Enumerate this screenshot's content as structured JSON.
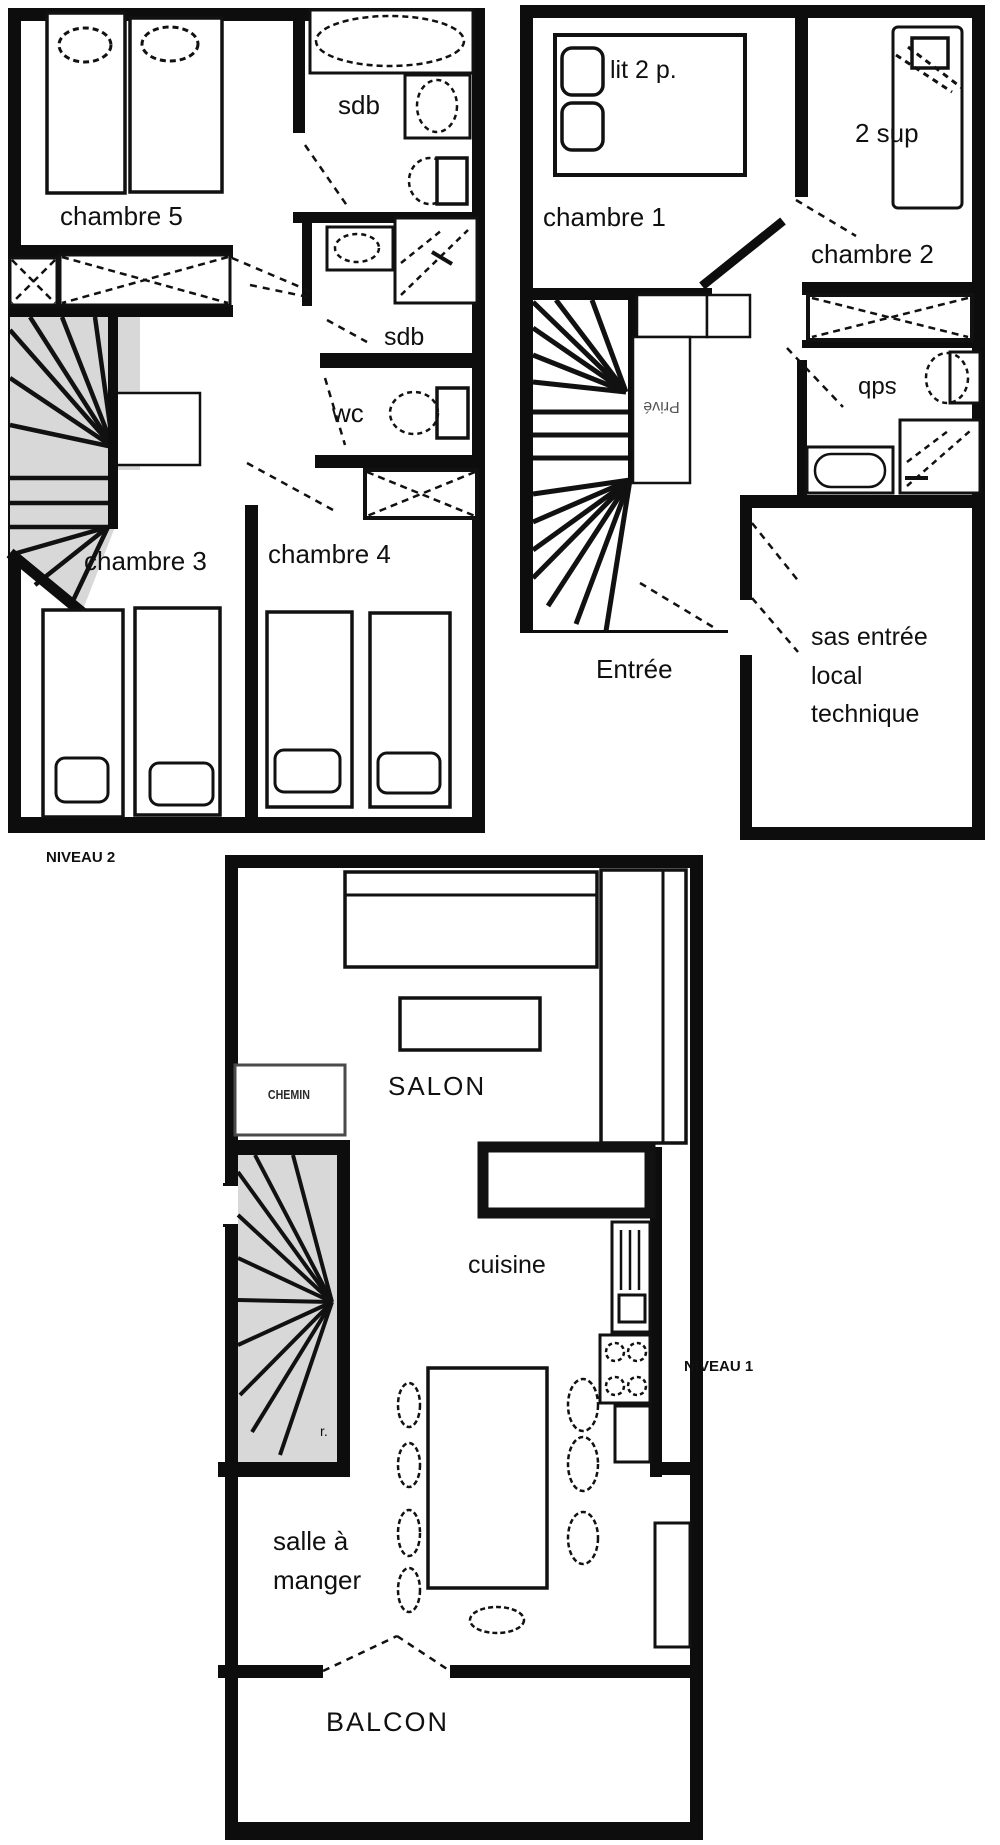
{
  "colors": {
    "wall": "#0d0d0d",
    "stair_fill": "#d8d8d8",
    "label": "#101010",
    "fireplace_border": "#4a4a4a"
  },
  "niveau2": {
    "level_label": "NIVEAU 2",
    "rooms": {
      "chambre5": "chambre 5",
      "chambre3": "chambre 3",
      "chambre4": "chambre 4",
      "sdb_top": "sdb",
      "sdb_mid": "sdb",
      "wc": "wc"
    }
  },
  "entry": {
    "rooms": {
      "chambre1": "chambre 1",
      "chambre2": "chambre 2",
      "bed_double": "lit 2 p.",
      "bed_sup": "2 sup",
      "sdb_rotated": "sdb",
      "prive": "Privé",
      "entree": "Entrée",
      "sas_line1": "sas entrée",
      "sas_line2": "local",
      "sas_line3": "technique"
    }
  },
  "niveau1": {
    "level_label": "NIVEAU 1",
    "rooms": {
      "salon": "SALON",
      "cuisine": "cuisine",
      "salle_line1": "salle à",
      "salle_line2": "manger",
      "balcon": "BALCON",
      "cheminee": "CHEMIN",
      "stair_note": "r."
    }
  }
}
